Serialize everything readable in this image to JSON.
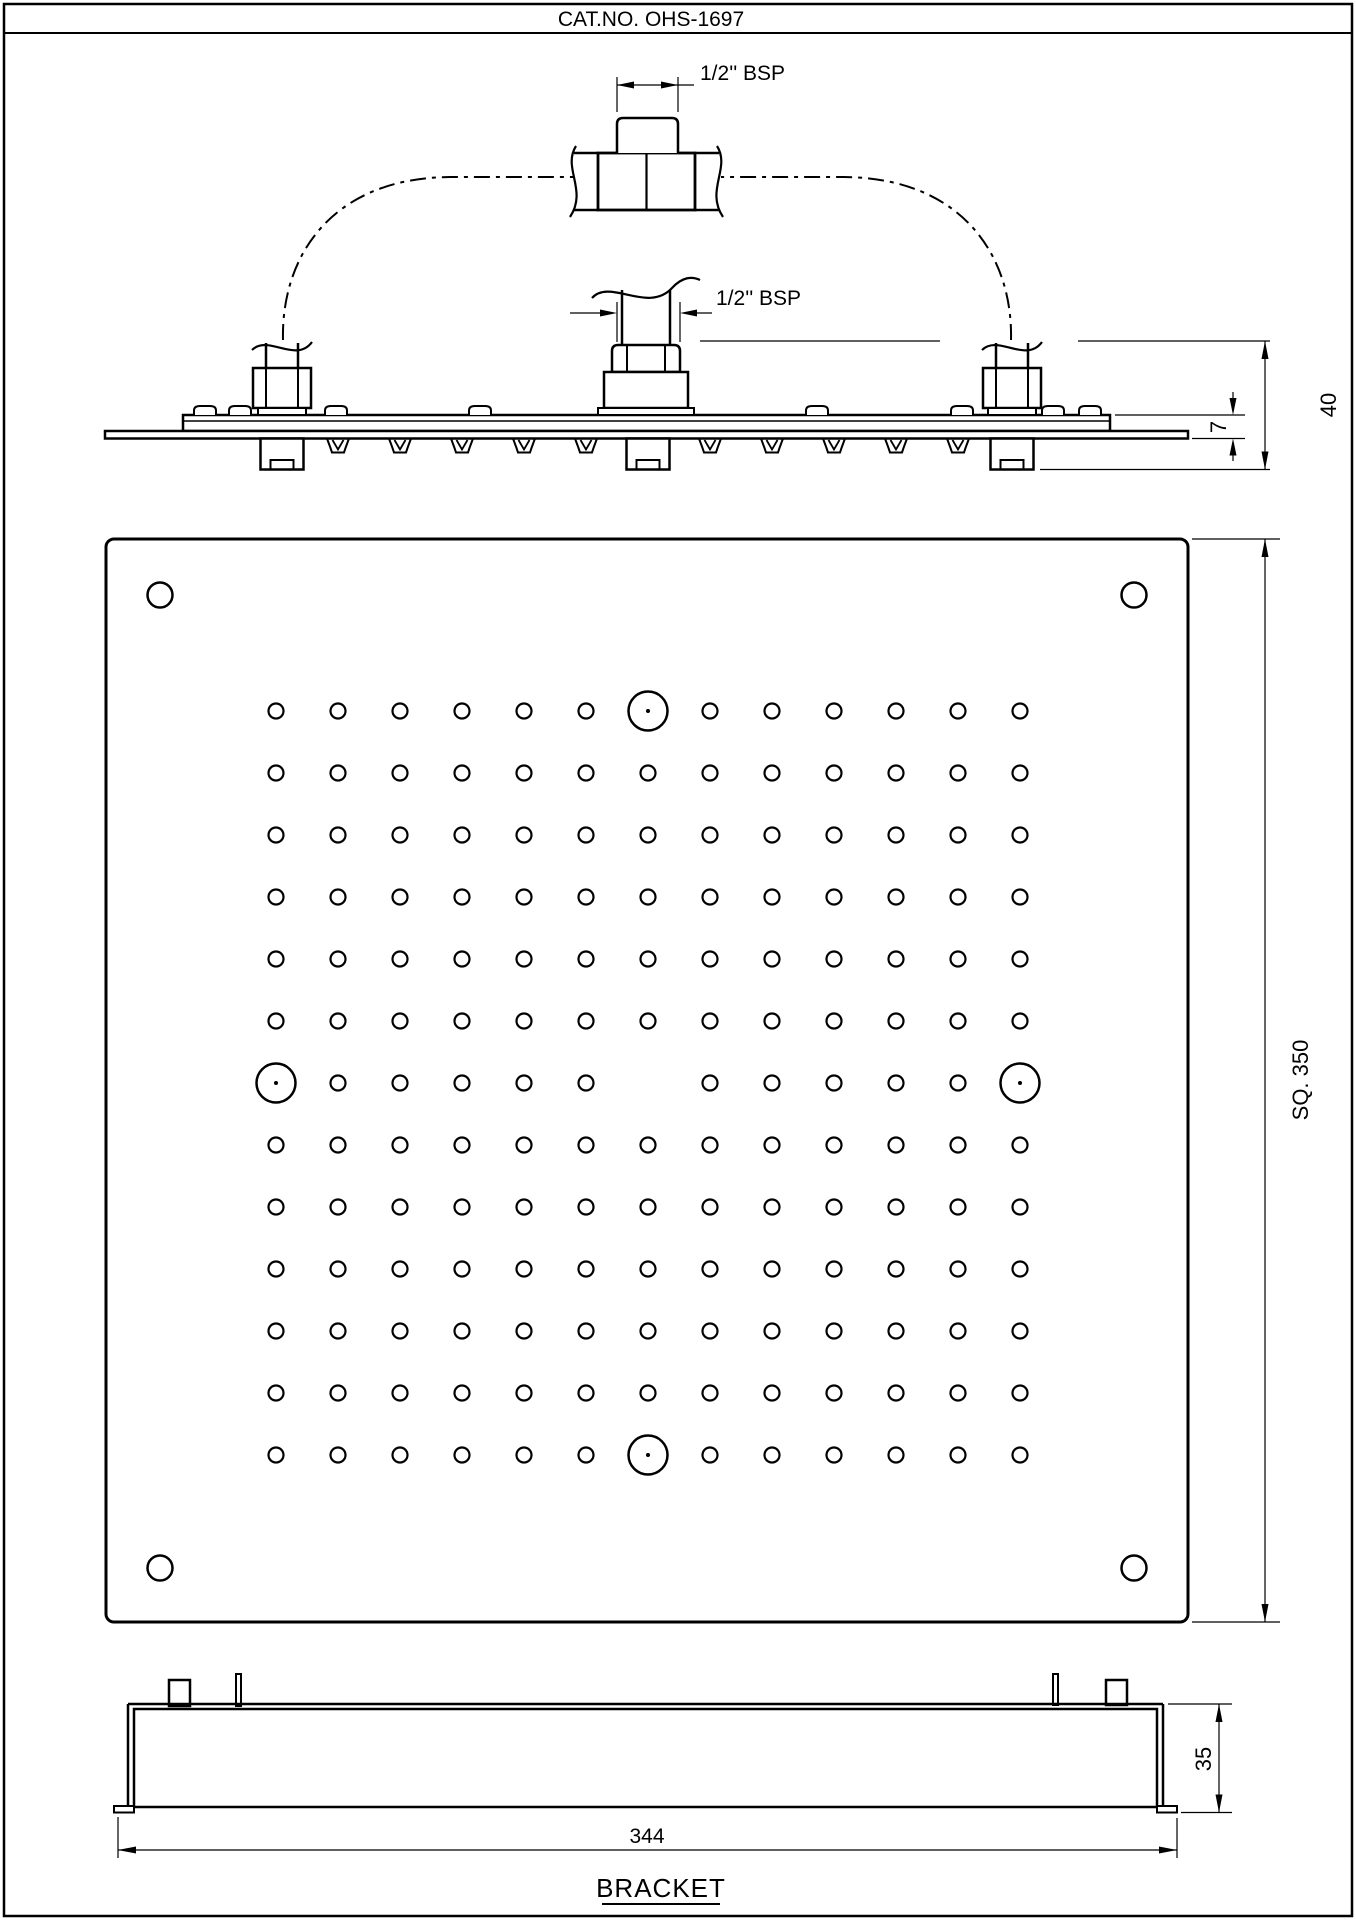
{
  "title": "CAT.NO. OHS-1697",
  "line_color": "#000000",
  "bg_color": "#ffffff",
  "side_view": {
    "bsp_top_label": "1/2'' BSP",
    "bsp_inlet_label": "1/2'' BSP",
    "dim_total_height": "40",
    "dim_plate_offset": "7"
  },
  "plan_view": {
    "dim_square_label": "SQ. 350",
    "grid": {
      "rows": 13,
      "cols": 13,
      "origin_x": 276,
      "origin_y": 711,
      "pitch": 62,
      "small_hole_r": 7.5,
      "large_hole_r": 19.5,
      "large_hole_dot_r": 2,
      "large_holes": [
        [
          1,
          7
        ],
        [
          7,
          1
        ],
        [
          7,
          13
        ],
        [
          13,
          7
        ]
      ],
      "omitted_holes": [
        [
          7,
          7
        ]
      ]
    },
    "corner_holes": {
      "r": 12.5,
      "centers": [
        [
          160,
          595
        ],
        [
          1134,
          595
        ],
        [
          160,
          1568
        ],
        [
          1134,
          1568
        ]
      ]
    }
  },
  "bracket_view": {
    "caption": "BRACKET",
    "dim_length": "344",
    "dim_height": "35"
  }
}
